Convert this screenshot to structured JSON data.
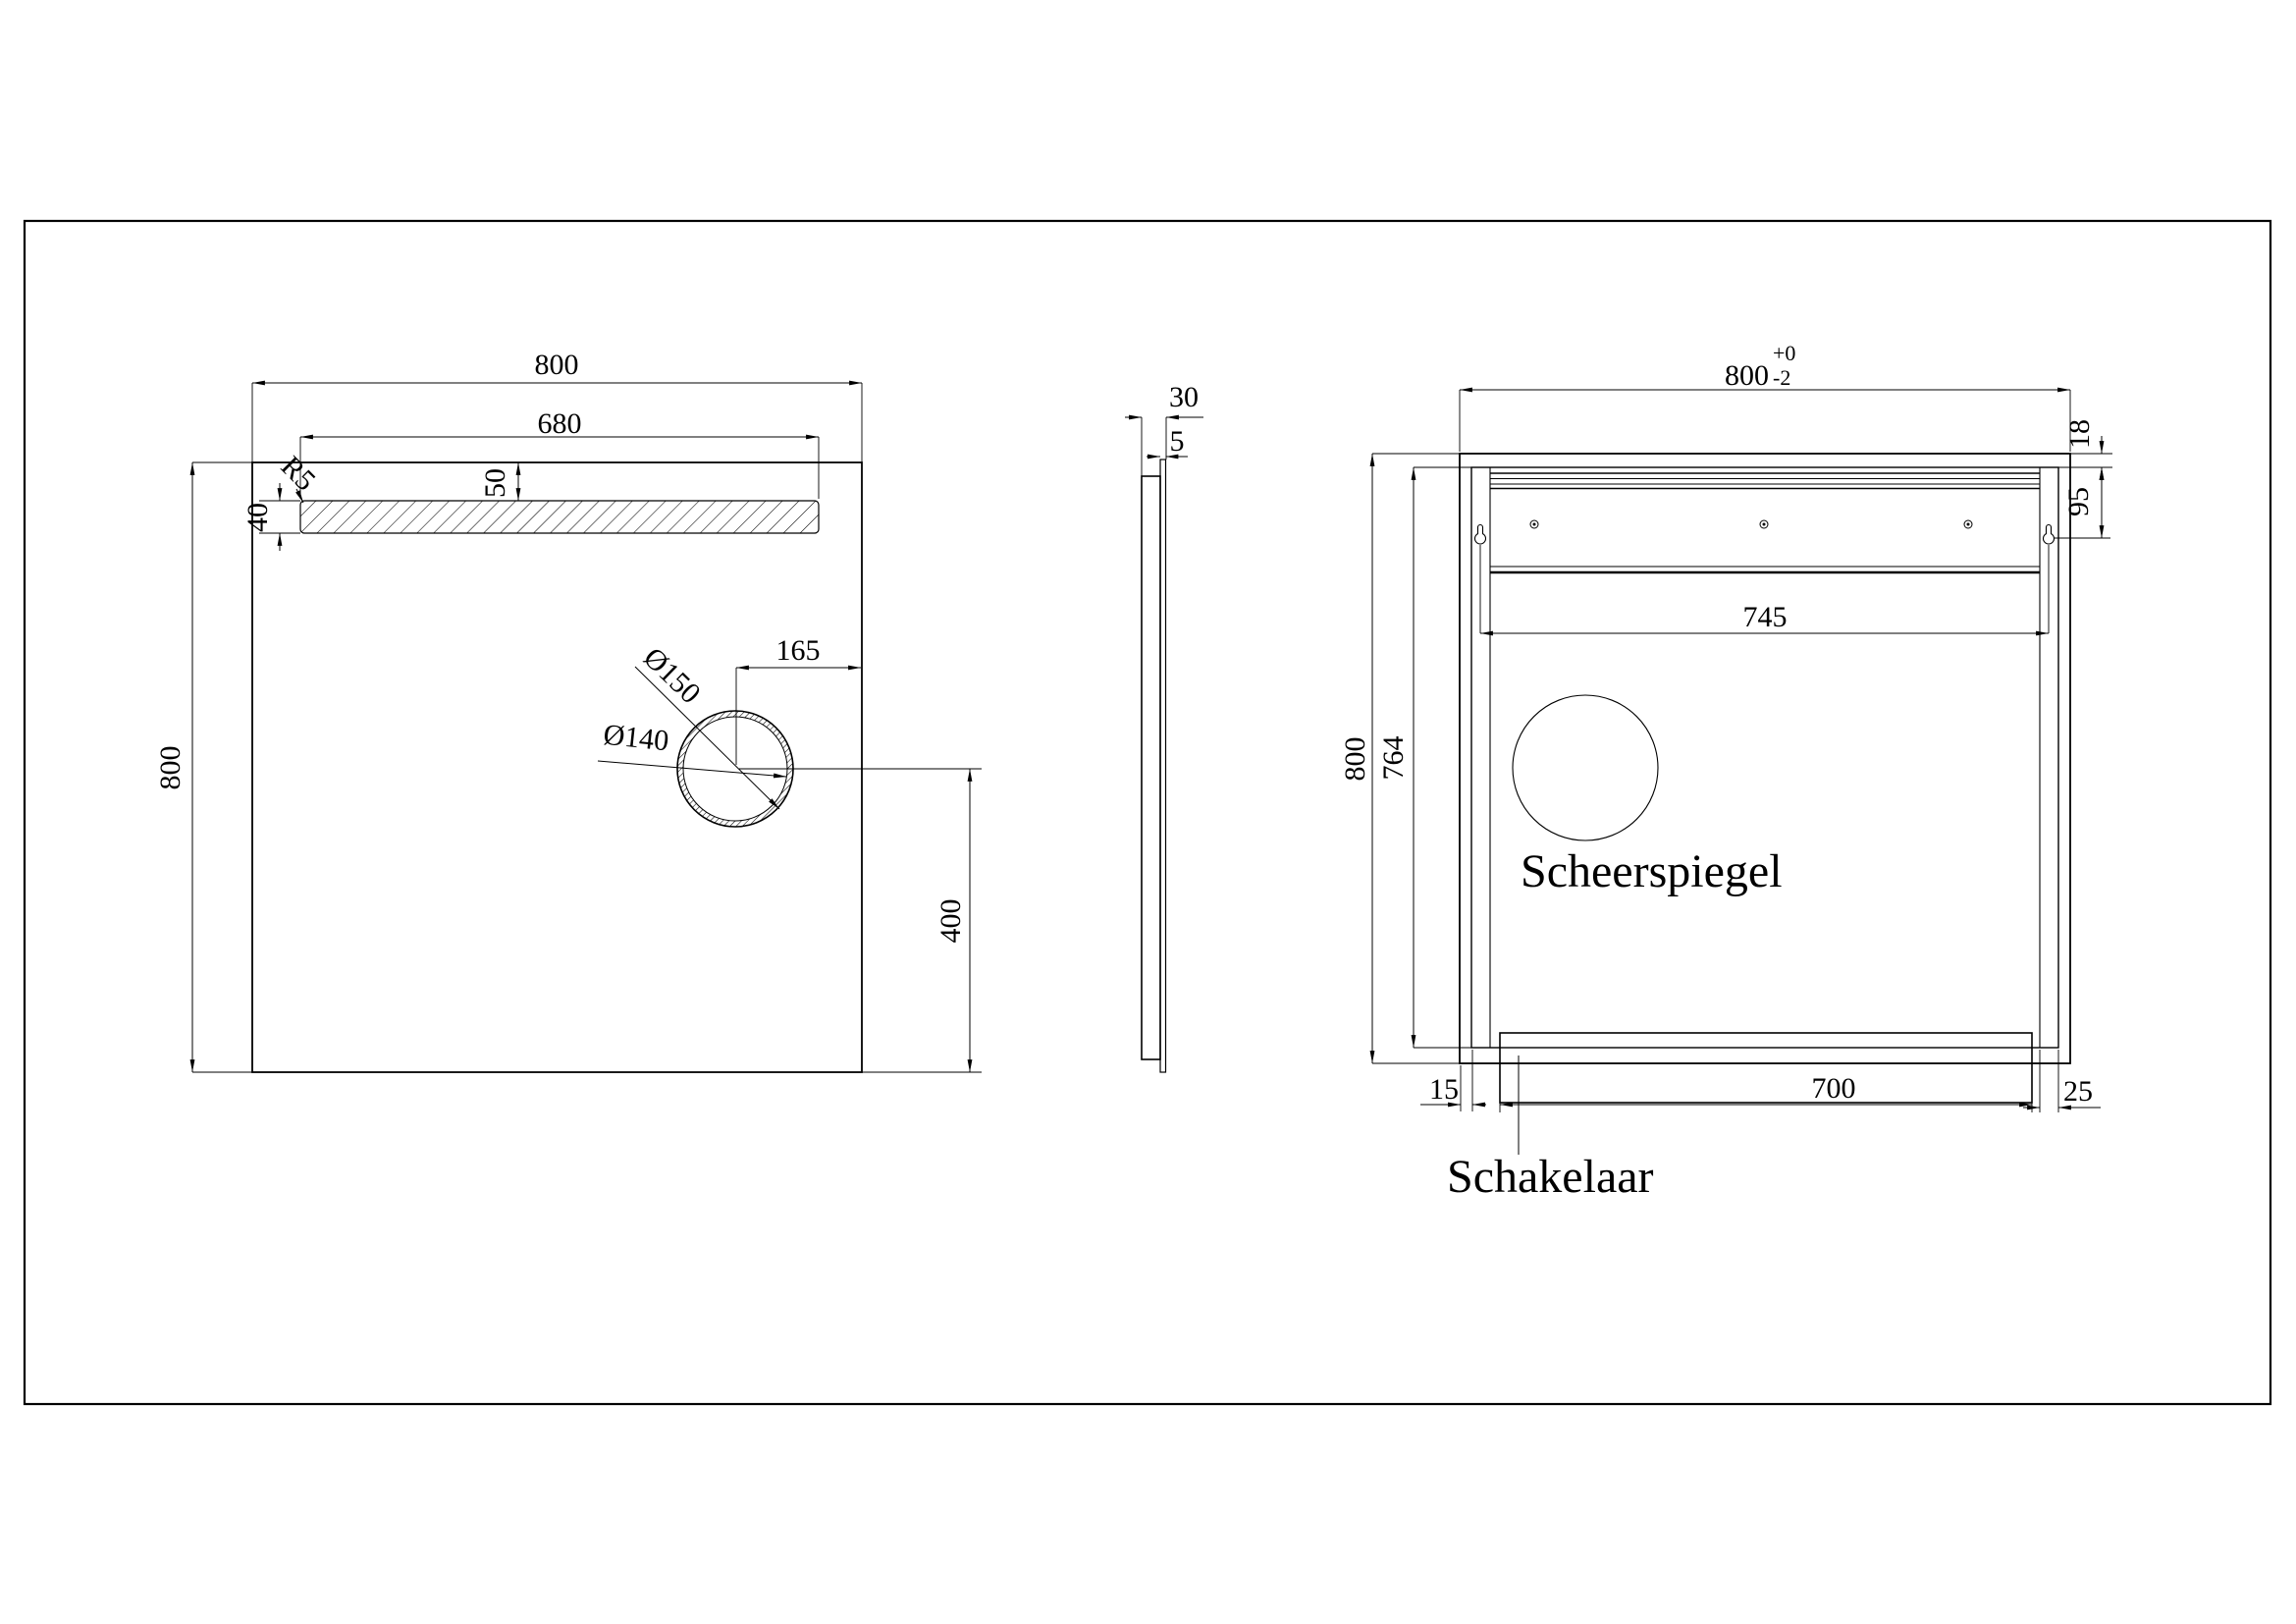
{
  "colors": {
    "line": "#000000",
    "background": "#ffffff"
  },
  "views": {
    "front": {
      "dim_width": "800",
      "dim_light_width": "680",
      "dim_height": "800",
      "dim_light_top_offset": "50",
      "dim_light_height": "40",
      "dim_corner_radius": "R5",
      "dim_hole_outer": "Ø150",
      "dim_hole_inner": "Ø140",
      "dim_hole_from_right": "165",
      "dim_hole_from_bottom": "400"
    },
    "side": {
      "dim_depth": "30",
      "dim_glass_thickness": "5"
    },
    "back": {
      "dim_width_nominal": "800",
      "dim_width_tol_upper": "+0",
      "dim_width_tol_lower": "-2",
      "dim_height": "800",
      "dim_frame_height": "764",
      "dim_hanger_span": "745",
      "dim_hanger_from_top": "95",
      "dim_glass_lip": "18",
      "dim_switch_bar_length": "700",
      "dim_edge_inset": "15",
      "dim_frame_thickness": "25",
      "label_shaving_mirror": "Scheerspiegel",
      "label_switch": "Schakelaar"
    }
  }
}
